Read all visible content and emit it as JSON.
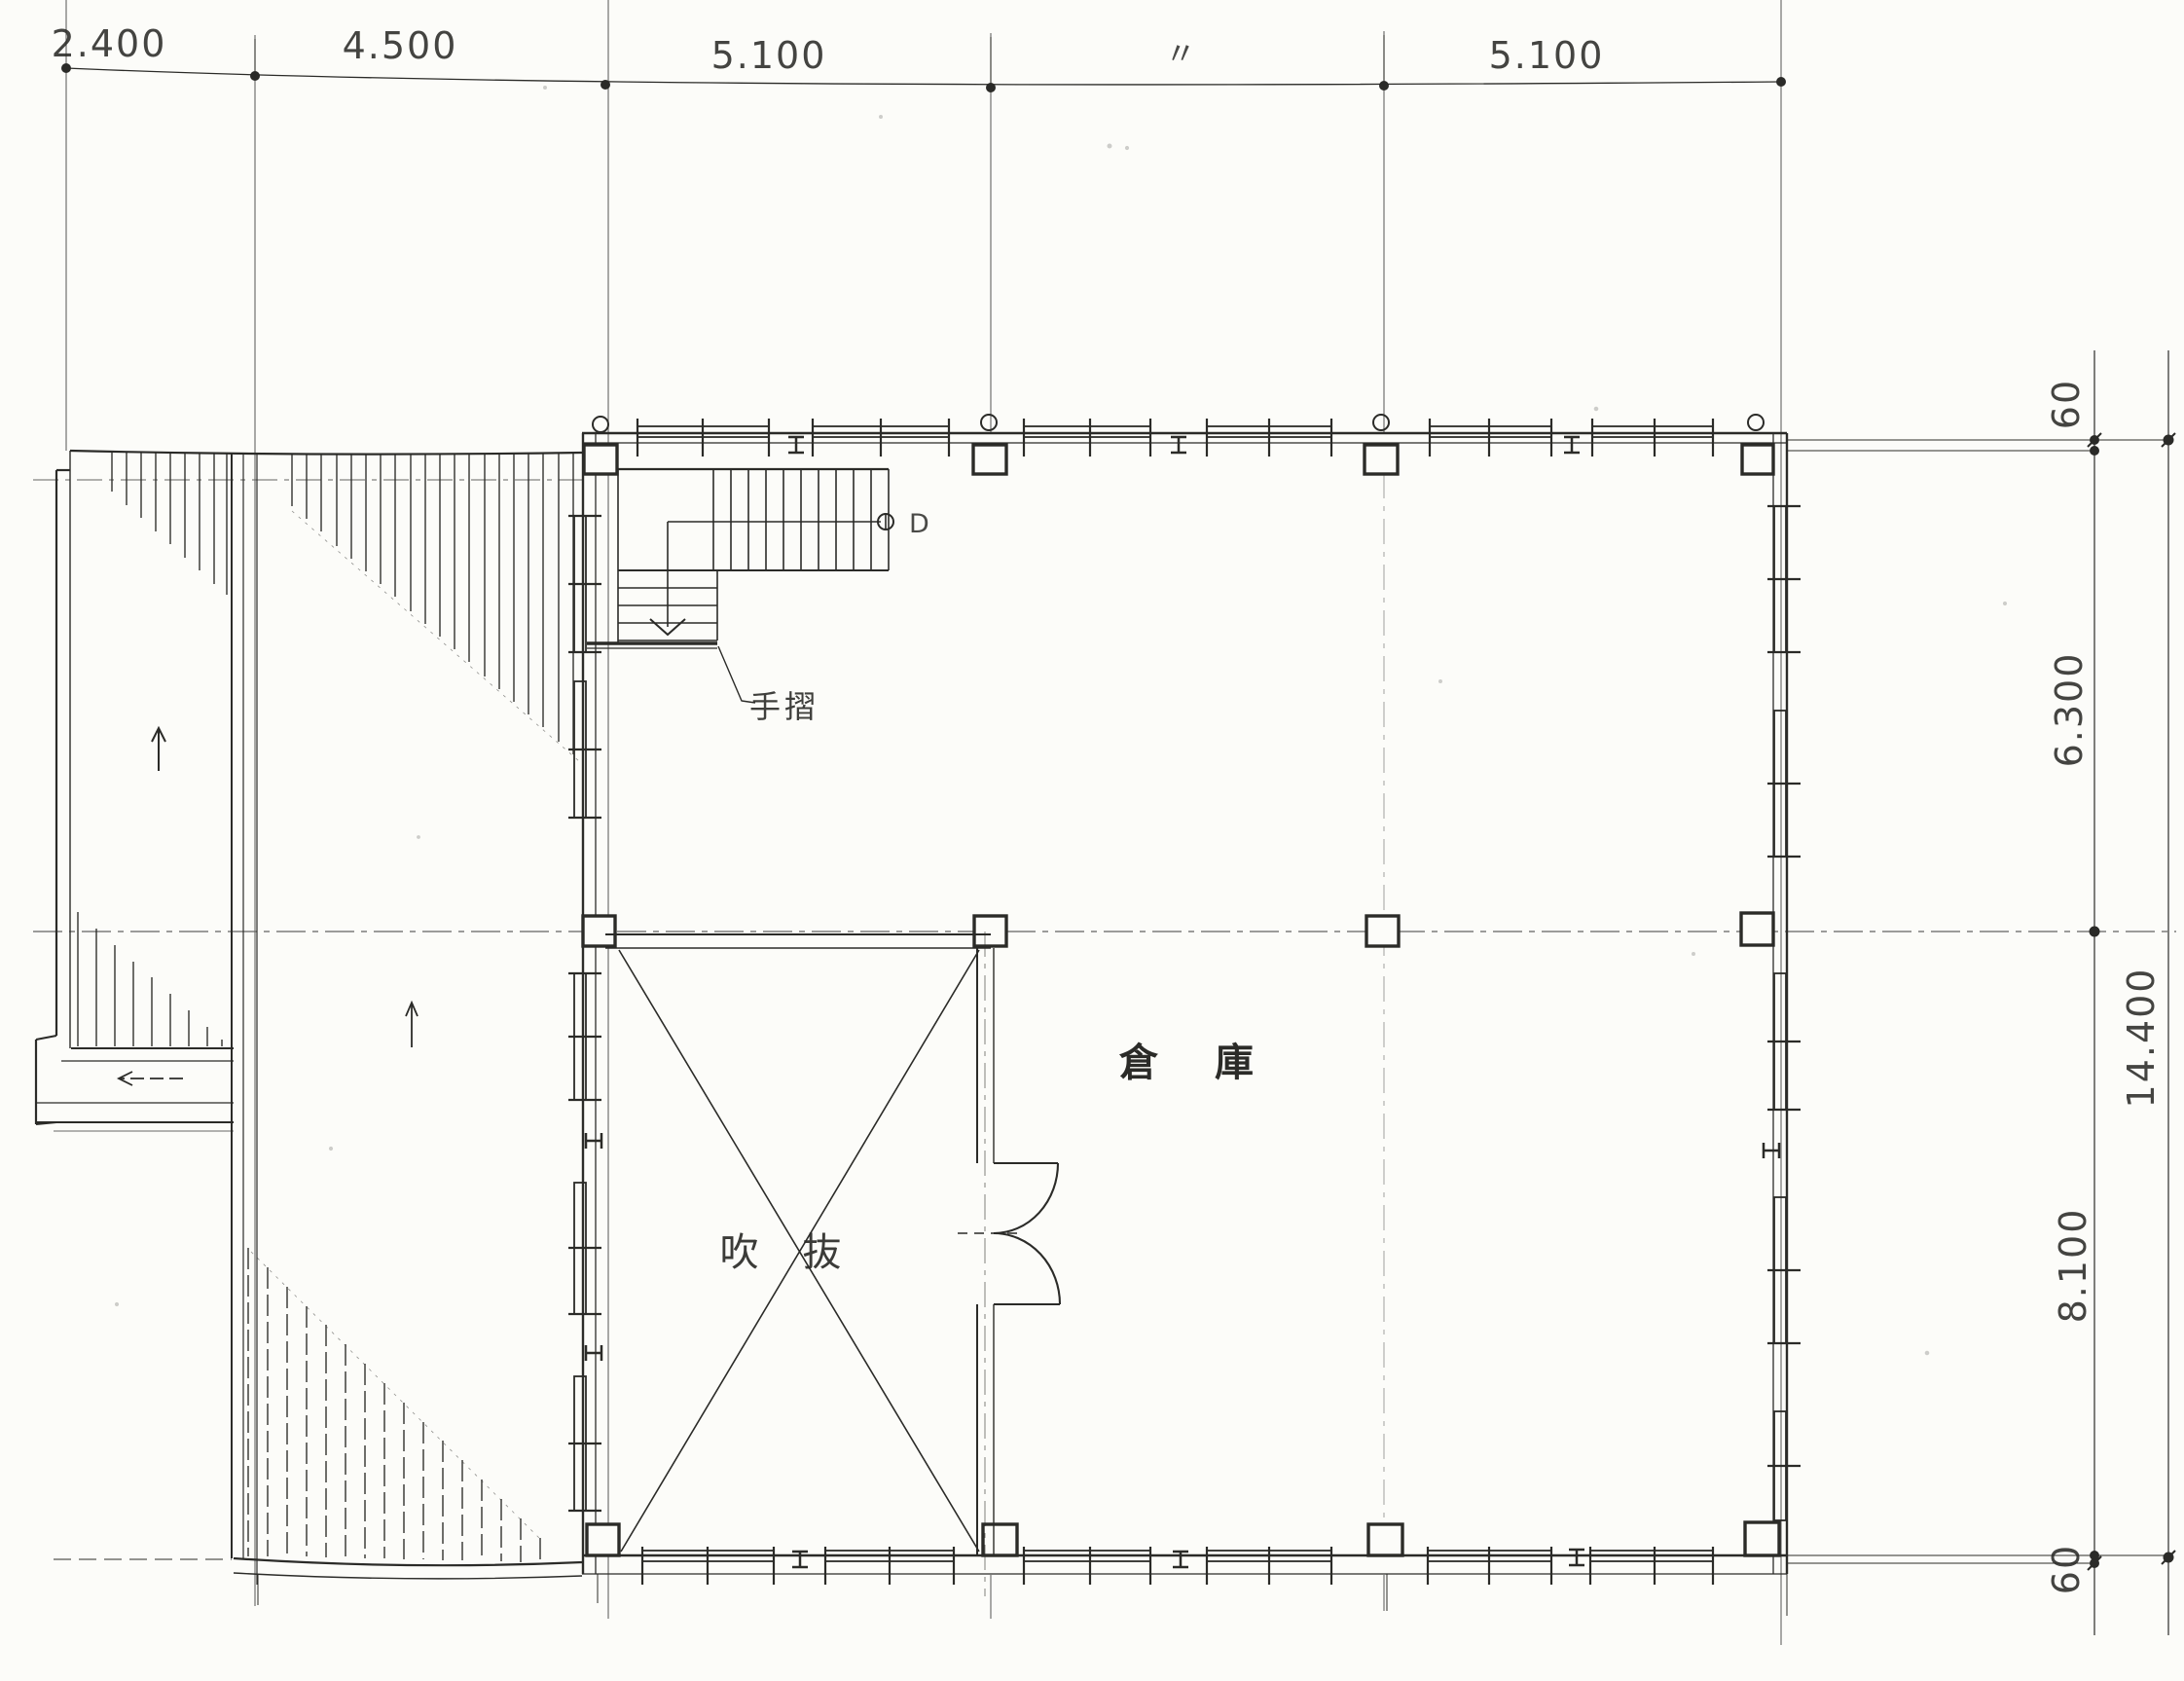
{
  "drawing": {
    "type": "architectural-floor-plan",
    "paper_color": "#fcfcf9",
    "ink_color": "#2b2b28",
    "top_dimensions": {
      "labels": [
        "2.400",
        "4.500",
        "5.100",
        "〃",
        "5.100"
      ]
    },
    "right_dimensions": {
      "labels": [
        "60",
        "6.300",
        "14.400",
        "8.100",
        "60"
      ]
    },
    "rooms": {
      "warehouse_label": "倉 庫",
      "void_label": "吹 抜"
    },
    "stair": {
      "handrail_label": "手摺",
      "newel_label": "D"
    }
  }
}
